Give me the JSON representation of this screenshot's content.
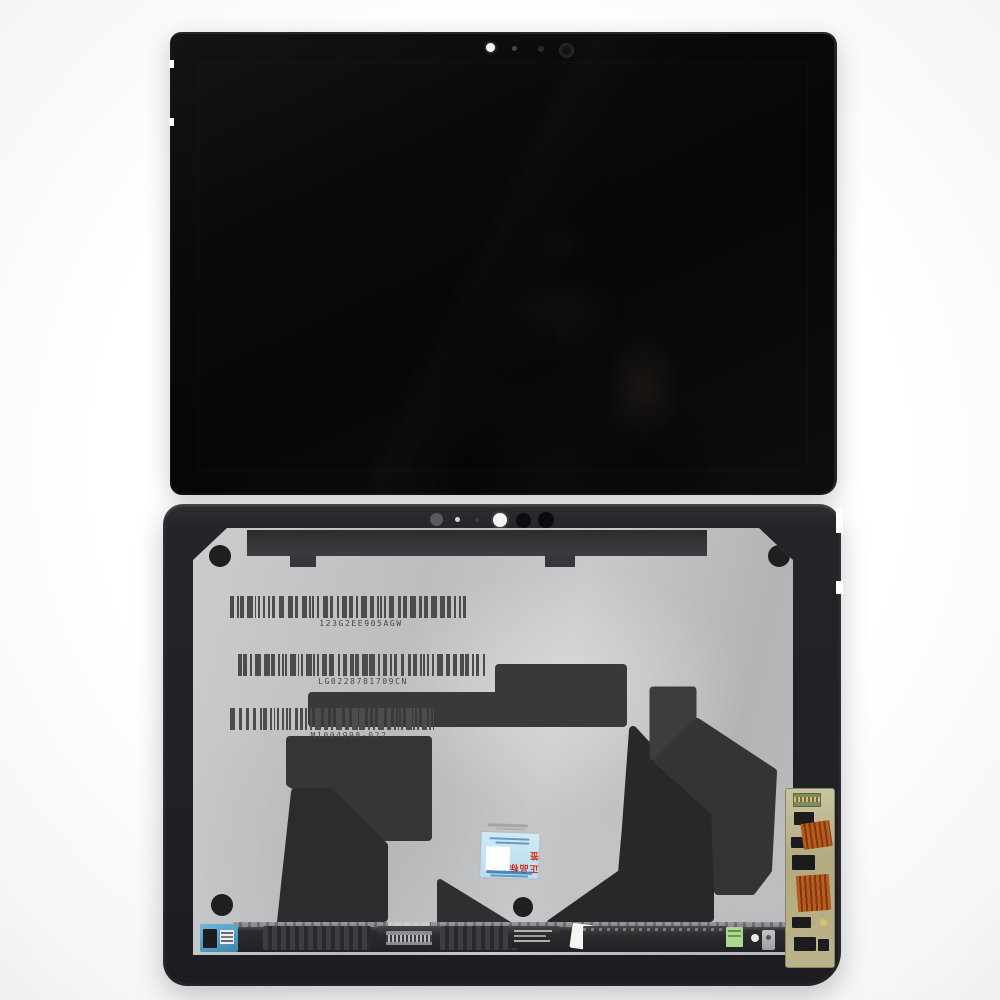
{
  "back_panel": {
    "barcodes": [
      {
        "value": "123G2EE905AGW"
      },
      {
        "value": "LG0228781709CN"
      },
      {
        "value": "M1004998-022"
      }
    ],
    "authenticity_sticker": {
      "red_text": "正品标签"
    }
  },
  "colors": {
    "background": "#ffffff",
    "front_glass": "#0a0a0b",
    "frame_black": "#232327",
    "panel_silver": "#c3c4c6",
    "adhesive_dark": "#303234",
    "barcode_ink": "#4c4c4f",
    "pcb_blue": "#5ba8ca",
    "pcb_tan": "#b8ae86",
    "flex_orange": "#b65c1e",
    "sticker_blue": "#bfe2f1",
    "sticker_red": "#d42a1a",
    "sticker_green": "#aad88c"
  }
}
